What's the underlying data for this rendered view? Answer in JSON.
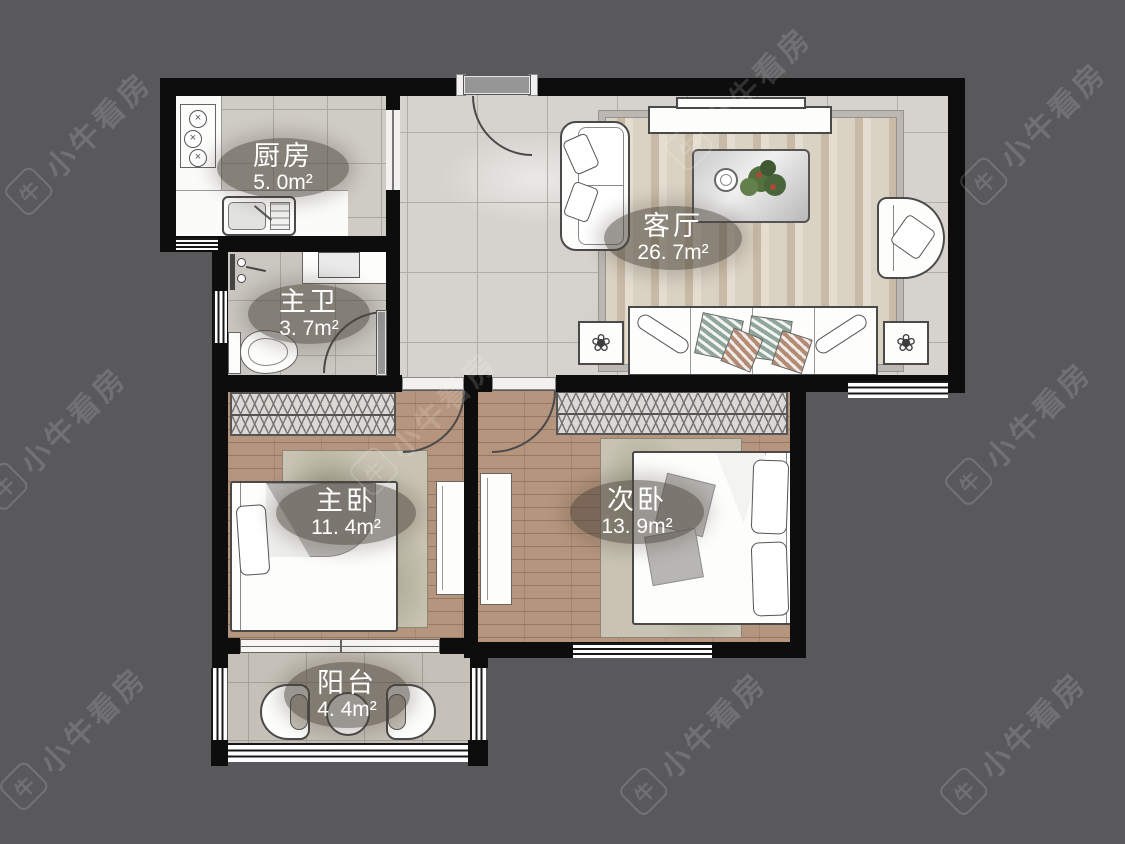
{
  "watermark": {
    "text": "小牛看房",
    "logo_glyph": "牛"
  },
  "rooms": [
    {
      "id": "kitchen",
      "name": "厨房",
      "area": "5. 0m²"
    },
    {
      "id": "bathroom",
      "name": "主卫",
      "area": "3. 7m²"
    },
    {
      "id": "living_room",
      "name": "客厅",
      "area": "26. 7m²"
    },
    {
      "id": "master_bedroom",
      "name": "主卧",
      "area": "11. 4m²"
    },
    {
      "id": "second_bedroom",
      "name": "次卧",
      "area": "13. 9m²"
    },
    {
      "id": "balcony",
      "name": "阳台",
      "area": "4. 4m²"
    }
  ],
  "icons": {
    "burner_glyph": "×",
    "plantbox_glyph": "❀"
  },
  "colors": {
    "background": "#59595b",
    "wall": "#0d0d0d",
    "tile_floor": "#d6d3ce",
    "wood_floor": "#b5957d",
    "balcony_floor": "#c6c1b8",
    "label_bubble": "rgba(72,66,56,0.55)",
    "label_text": "#ffffff",
    "watermark": "rgba(255,255,255,0.15)"
  }
}
